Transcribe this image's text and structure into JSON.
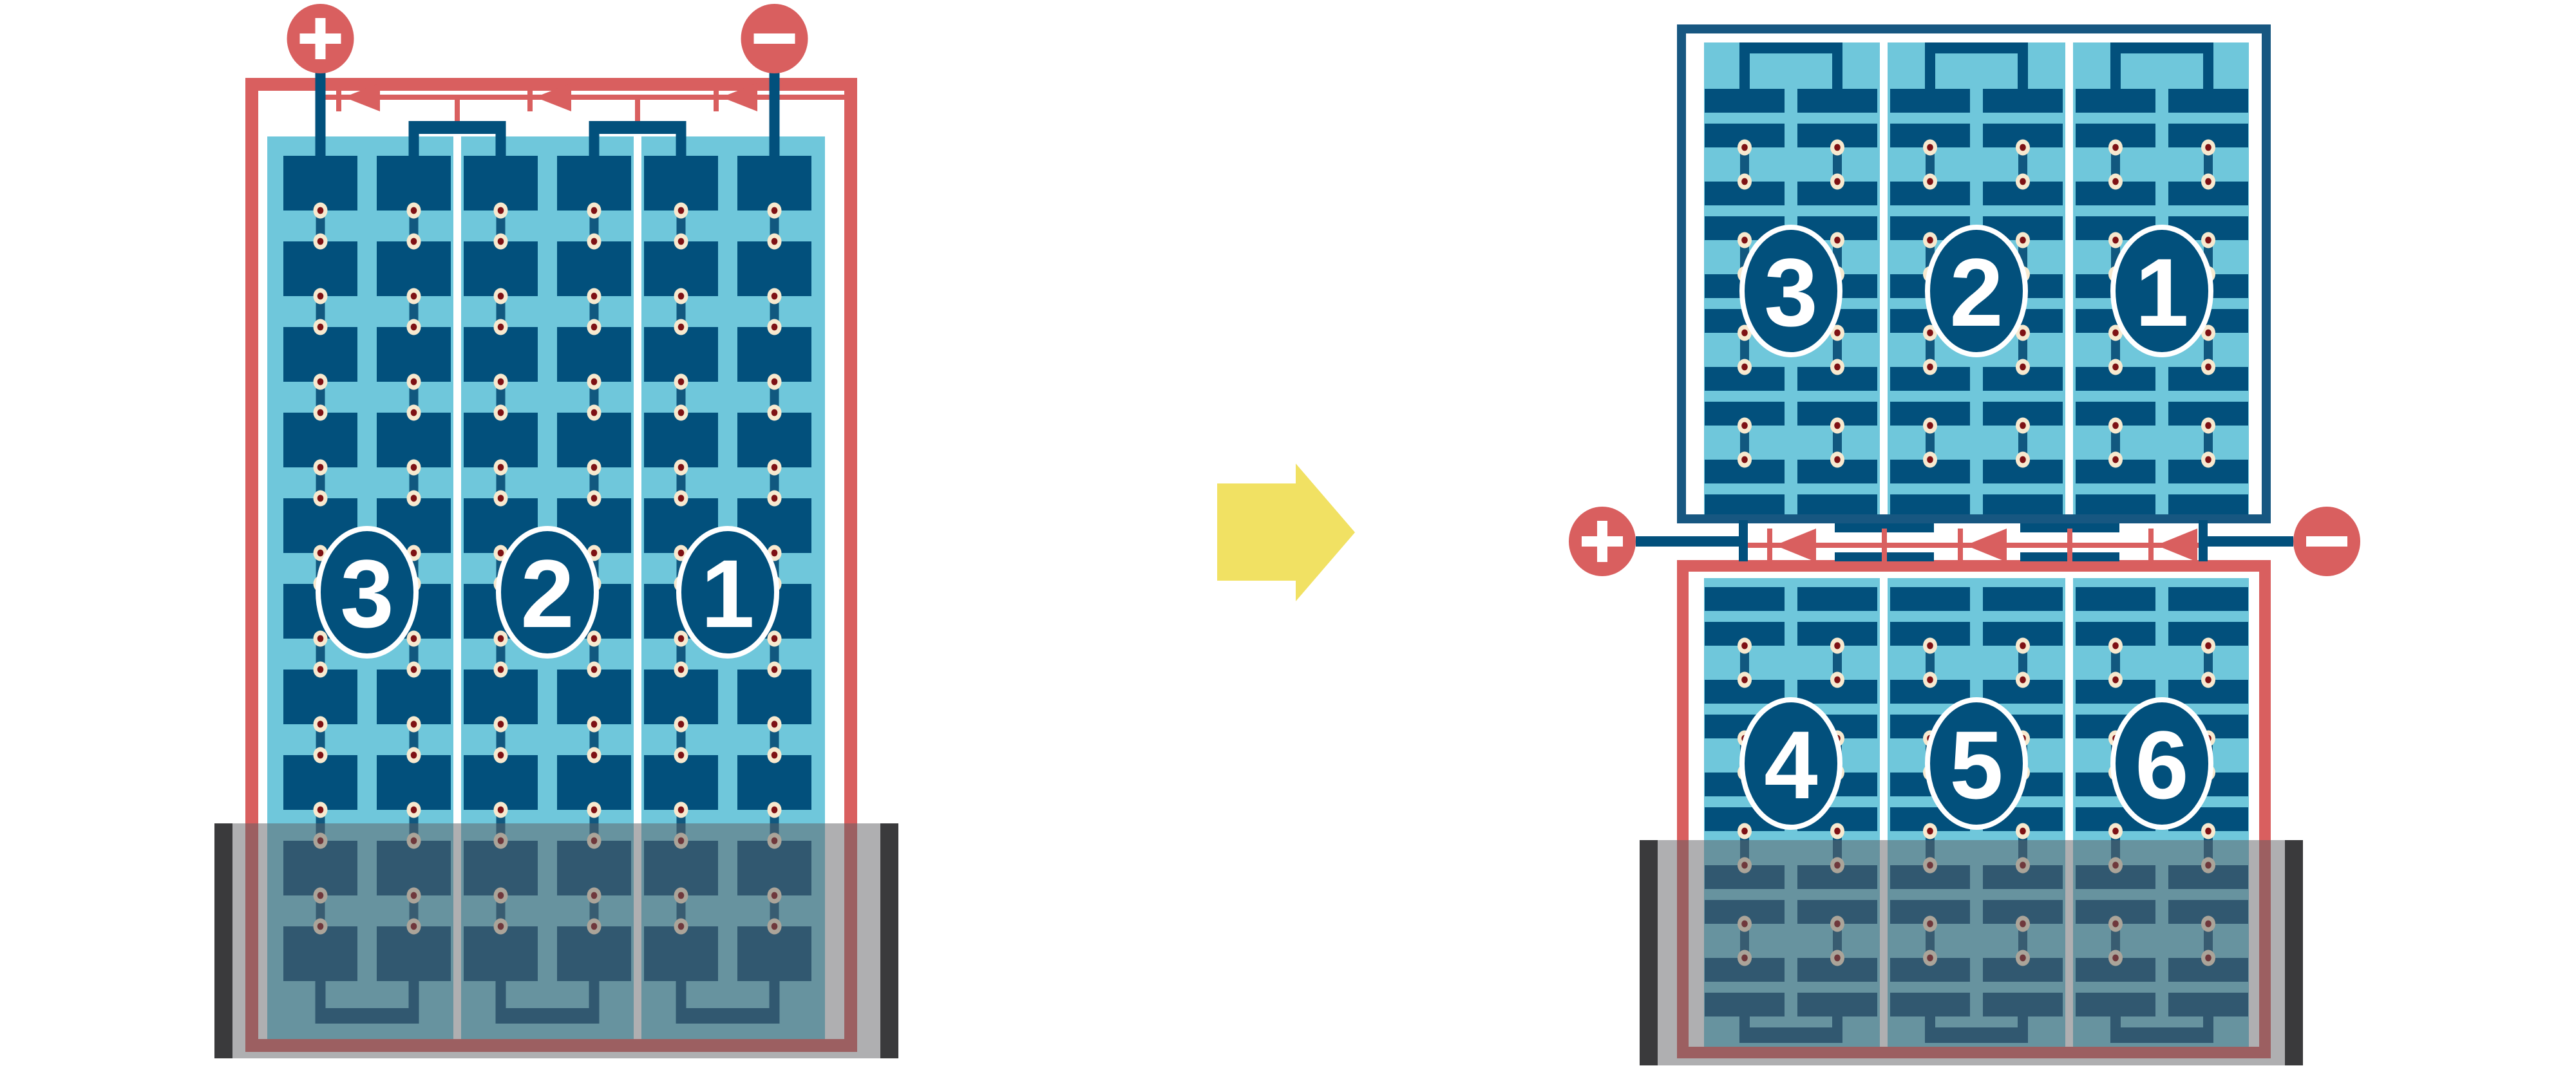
{
  "diagram": {
    "type": "solar-module-wiring-comparison",
    "left_module": {
      "substring_labels": [
        "3",
        "2",
        "1"
      ],
      "positive_terminal": "+",
      "negative_terminal": "−",
      "bypass_diodes": 3,
      "cell_columns": 6,
      "cell_rows": 10,
      "shaded_bottom_rows": 2
    },
    "right_module": {
      "top_half_labels": [
        "3",
        "2",
        "1"
      ],
      "bottom_half_labels": [
        "4",
        "5",
        "6"
      ],
      "positive_terminal": "+",
      "negative_terminal": "−",
      "bypass_diodes": 3,
      "cell_columns": 6,
      "shaded_area": "bottom rows of lower half"
    },
    "transition_arrow": {
      "direction": "right"
    },
    "colors": {
      "red": "#D95F5F",
      "navy": "#02507C",
      "frame_navy": "#175781",
      "light_blue": "#6FC7DB",
      "white": "#FFFFFF",
      "link_bar": "#11587F",
      "dot_cream": "#F7E9CF",
      "dot_core": "#7E1114",
      "arrow_yellow": "#F1E163",
      "shade_overlay": "rgba(95,95,99,0.50)",
      "shade_bar": "#3A3A3C"
    }
  }
}
